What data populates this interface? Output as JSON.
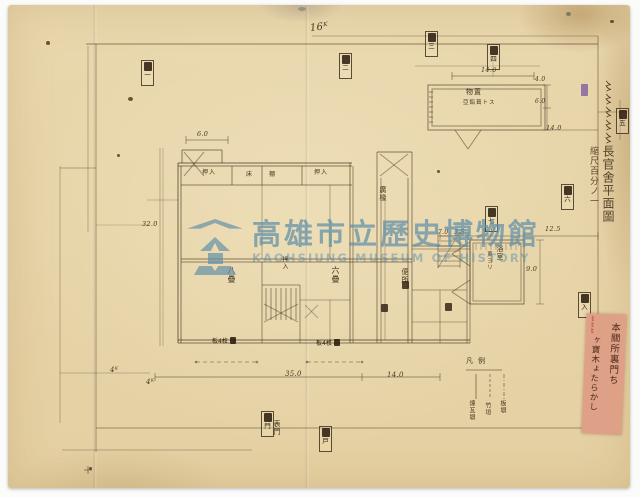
{
  "watermark": {
    "logo": "kaohsiung-museum-emblem",
    "title_zh": "高雄市立歷史博物館",
    "title_en": "KAOHSIUNG MUSEUM OF HISTORY",
    "color": "#5E8FA8"
  },
  "side_note": {
    "title": "〻〻〻〻〻長官舍平面圖",
    "scale": "縮尺百分ノ一"
  },
  "red_slip": {
    "col_right": "本關所裏門ち",
    "col_left": "ヶ寶木ょたらかし",
    "red_note": "〻〻〻"
  },
  "annotations": {
    "k16": "16ᴷ",
    "k4_a": "4ᴷ",
    "k4_b": "4ᴷ",
    "deg32": "32.0",
    "note_a": "板4枚",
    "note_b": "板4枚"
  },
  "dims": [
    "6.0",
    "14.0",
    "4.0",
    "6.0",
    "14.0",
    "7.0",
    "3.5",
    "6.0",
    "12.5",
    "9.0",
    "35.0",
    "14.0"
  ],
  "rooms": {
    "closet_1": "押入",
    "toko": "床",
    "tana": "棚",
    "closet_2": "押入",
    "room_8": "八疊",
    "closet_mid": "押入",
    "room_6": "六疊",
    "veranda": "廣椽",
    "toilet": "便所",
    "gate": "表門"
  },
  "details": {
    "shed_name": "物置",
    "shed_note": "亞鉛葺トス",
    "bath_name": "浴室",
    "bath_note": "東ヨリ"
  },
  "legend": {
    "header": "凡例",
    "items": [
      "煉瓦塀",
      "竹垣",
      "板塀"
    ]
  },
  "tags": [
    "一",
    "二",
    "三",
    "四",
    "五",
    "六",
    "七",
    "入",
    "門",
    "戸"
  ],
  "ink_color": "#3e2c1a",
  "paper_color": "#e7d5aa"
}
